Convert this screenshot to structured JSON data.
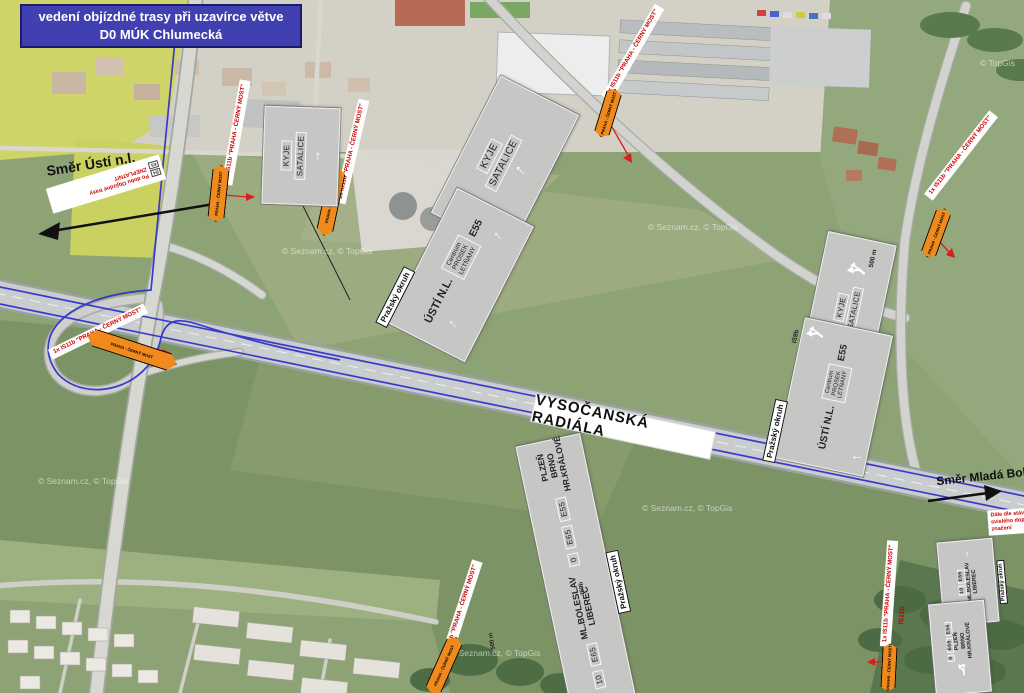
{
  "title": {
    "line1": "vedení objízdné trasy při uzavírce větve",
    "line2": "D0 MÚK Chlumecká"
  },
  "directions": {
    "west": "Směr Ústí n.l.",
    "east": "Směr Mladá Boleslav"
  },
  "road_label": "VYSOČANSKÁ RADIÁLA",
  "notes": {
    "existing_signage": "Dále dle stávajícího svislého dopravního značení",
    "invalidate_line1": "Po dobu Objízdné trasy",
    "invalidate_line2": "ZNEPLATNIT",
    "invalidate_badges": {
      "b1": "B4",
      "b2": "E5"
    }
  },
  "marker": {
    "label": "1x IS11b \"PRAHA - ČERNÝ MOST\"",
    "bar_text": "PRAHA - ČERNÝ MOST",
    "code": "IS11b"
  },
  "signs": {
    "code_is9b": "IS9b",
    "distance_500": "500 m",
    "kyje": {
      "line1": "KYJE",
      "line2": "SATALICE"
    },
    "usti": {
      "tab": "Pražský okruh",
      "main": "ÚSTÍ N.L.",
      "box1": "Centrum",
      "box2": "PROSEK",
      "box3": "LETŇANY",
      "route": "E55"
    },
    "boleslav": {
      "tab": "Pražský okruh",
      "badge": "10",
      "route": "E65",
      "line1": "ML.BOLESLAV",
      "line2": "LIBEREC"
    },
    "plzen": {
      "badge": "0",
      "route1": "E65",
      "route2": "E55",
      "line1": "PLZEŇ",
      "line2": "BRNO",
      "line3": "HR.KRÁLOVÉ"
    }
  },
  "watermarks": {
    "seznam": "© Seznam.cz, © TopGis",
    "topgis": "© TopGis"
  },
  "colors": {
    "route_blue": "#2a2acd",
    "marker_orange": "#f08a1d",
    "sign_gray": "#c6c7c5",
    "label_red": "#cc0000",
    "title_bg": "#4040b0"
  }
}
